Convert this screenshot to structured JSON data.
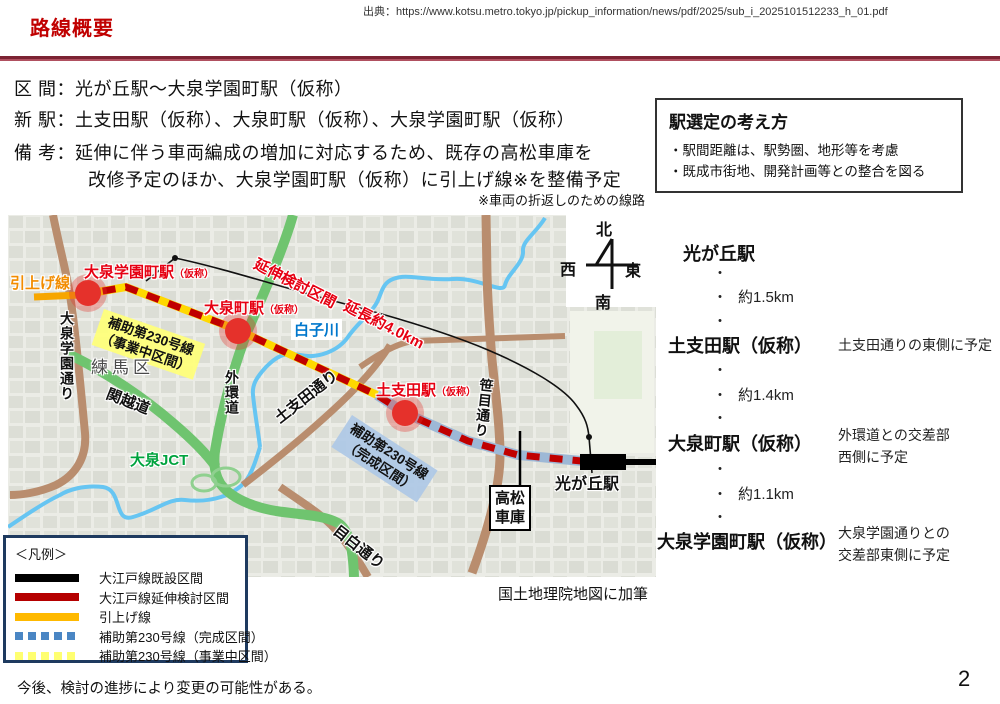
{
  "header": {
    "title": "路線概要",
    "source": "出典：https://www.kotsu.metro.tokyo.jp/pickup_information/news/pdf/2025/sub_i_2025101512233_h_01.pdf"
  },
  "overview": {
    "section_label": "区 間：",
    "section_value": "光が丘駅～大泉学園町駅（仮称）",
    "new_stations_label": "新 駅：",
    "new_stations_value": "土支田駅（仮称）、大泉町駅（仮称）、大泉学園町駅（仮称）",
    "remarks_label": "備 考：",
    "remarks_line1": "延伸に伴う車両編成の増加に対応するため、既存の高松車庫を",
    "remarks_line2": "改修予定のほか、大泉学園町駅（仮称）に引上げ線※を整備予定",
    "remarks_note": "※車両の折返しのための線路"
  },
  "selection_box": {
    "title": "駅選定の考え方",
    "point1": "・駅間距離は、駅勢圏、地形等を考慮",
    "point2": "・既成市街地、開発計画等との整合を図る"
  },
  "station_sequence": {
    "dot": "・",
    "stations": [
      {
        "name": "光が丘駅",
        "note": ""
      },
      {
        "name": "土支田駅（仮称）",
        "note": "土支田通りの東側に予定"
      },
      {
        "name": "大泉町駅（仮称）",
        "note": "外環道との交差部\n西側に予定"
      },
      {
        "name": "大泉学園町駅（仮称）",
        "note": "大泉学園通りとの\n交差部東側に予定"
      }
    ],
    "distances": [
      "約1.5km",
      "約1.4km",
      "約1.1km"
    ]
  },
  "map": {
    "caption": "国土地理院地図に加筆",
    "compass": {
      "north": "北",
      "south": "南",
      "east": "東",
      "west": "西"
    },
    "colors": {
      "extension_dash": "#C00000",
      "existing_line": "#000000",
      "pullout_line": "#F7A600",
      "hojo_ongoing_yellow": "#FFD800",
      "hojo_completed_blue": "#9DB8D6",
      "station_dot": "#E5312B",
      "river": "#66C5F2",
      "expressway_green": "#6FC46F",
      "road_brown": "#B98D6E"
    },
    "labels": {
      "pullout_line": "引上げ線",
      "oizumi_gakuencho_station": "大泉学園町駅",
      "oizumi_machi_station": "大泉町駅",
      "toshida_station": "土支田駅",
      "kasho": "（仮称）",
      "hojo230": "補助第230号線",
      "hojo230_ongoing": "（事業中区間）",
      "hojo230_completed": "（完成区間）",
      "extension_section": "延伸検討区間",
      "extension_length": "延長約4.0km",
      "shirako_river": "白子川",
      "nerima_ward": "練馬区",
      "oizumi_gakuen_dori": "大泉学園通り",
      "kanetsu_expwy": "関越道",
      "gaikan_expwy": "外環道",
      "oizumi_jct": "大泉JCT",
      "toshida_dori": "土支田通り",
      "sasame_dori": "笹目通り",
      "mejiro_dori": "目白通り",
      "takamatsu_depot": "高松\n車庫",
      "hikarigaoka_station": "光が丘駅"
    }
  },
  "legend": {
    "title": "＜凡例＞",
    "items": [
      {
        "label": "大江戸線既設区間",
        "style": "solid",
        "color": "#000000"
      },
      {
        "label": "大江戸線延伸検討区間",
        "style": "solid",
        "color": "#B50000"
      },
      {
        "label": "引上げ線",
        "style": "solid",
        "color": "#FFB900"
      },
      {
        "label": "補助第230号線（完成区間）",
        "style": "dashed",
        "color": "#4A86C4"
      },
      {
        "label": "補助第230号線（事業中区間）",
        "style": "dashed",
        "color": "#FFFF70"
      }
    ]
  },
  "footer": {
    "note": "今後、検討の進捗により変更の可能性がある。",
    "page": "2"
  }
}
